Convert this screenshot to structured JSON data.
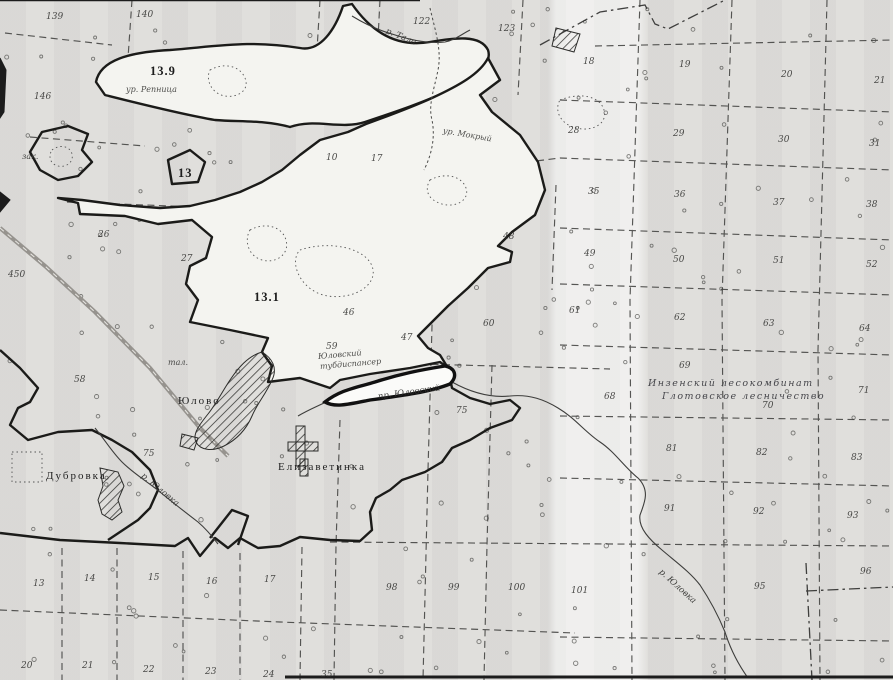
{
  "map": {
    "title": "Лесоустроительный планшет (скан)",
    "district_label": {
      "line1": "Инзенский лесокомбинат",
      "line2": "Глотовское лесничество"
    },
    "settlements": [
      {
        "text": "Юлово",
        "x": 178,
        "y": 395
      },
      {
        "text": "Елизаветинка",
        "x": 278,
        "y": 461
      },
      {
        "text": "Дубровка",
        "x": 46,
        "y": 470
      }
    ],
    "water_labels": [
      {
        "text": "р. Тала",
        "x": 386,
        "y": 26,
        "rotate": 22
      },
      {
        "text": "пр. Юловский",
        "x": 378,
        "y": 392,
        "rotate": -8
      },
      {
        "text": "р. Юловка",
        "x": 142,
        "y": 470,
        "rotate": 40
      },
      {
        "text": "р. Юловка",
        "x": 660,
        "y": 566,
        "rotate": 42
      }
    ],
    "place_labels": [
      {
        "text": "ур. Мокрый",
        "x": 443,
        "y": 126,
        "rotate": 10
      },
      {
        "text": "ур. Репница",
        "x": 126,
        "y": 85,
        "rotate": 0
      },
      {
        "text": "Юловский",
        "x": 318,
        "y": 352,
        "rotate": -5
      },
      {
        "text": "тубдиспансер",
        "x": 320,
        "y": 362,
        "rotate": -5
      },
      {
        "text": "зак.",
        "x": 22,
        "y": 152,
        "rotate": 0
      },
      {
        "text": "тал.",
        "x": 168,
        "y": 358,
        "rotate": 0
      }
    ],
    "compartment_labels": [
      {
        "text": "13.9",
        "x": 150,
        "y": 64
      },
      {
        "text": "13.1",
        "x": 254,
        "y": 290
      },
      {
        "text": "13",
        "x": 178,
        "y": 166
      }
    ],
    "quarter_numbers": [
      {
        "t": "139",
        "x": 46,
        "y": 12
      },
      {
        "t": "140",
        "x": 136,
        "y": 10
      },
      {
        "t": "122",
        "x": 413,
        "y": 17
      },
      {
        "t": "123",
        "x": 498,
        "y": 24
      },
      {
        "t": "146",
        "x": 34,
        "y": 92
      },
      {
        "t": "18",
        "x": 583,
        "y": 57
      },
      {
        "t": "19",
        "x": 679,
        "y": 60
      },
      {
        "t": "20",
        "x": 781,
        "y": 70
      },
      {
        "t": "21",
        "x": 874,
        "y": 76
      },
      {
        "t": "28",
        "x": 568,
        "y": 126
      },
      {
        "t": "29",
        "x": 673,
        "y": 129
      },
      {
        "t": "30",
        "x": 778,
        "y": 135
      },
      {
        "t": "31",
        "x": 869,
        "y": 139
      },
      {
        "t": "35",
        "x": 588,
        "y": 187
      },
      {
        "t": "36",
        "x": 674,
        "y": 190
      },
      {
        "t": "37",
        "x": 773,
        "y": 198
      },
      {
        "t": "38",
        "x": 866,
        "y": 200
      },
      {
        "t": "10",
        "x": 326,
        "y": 153
      },
      {
        "t": "17",
        "x": 371,
        "y": 154
      },
      {
        "t": "26",
        "x": 98,
        "y": 230
      },
      {
        "t": "27",
        "x": 181,
        "y": 254
      },
      {
        "t": "48",
        "x": 503,
        "y": 232
      },
      {
        "t": "49",
        "x": 584,
        "y": 249
      },
      {
        "t": "50",
        "x": 673,
        "y": 255
      },
      {
        "t": "51",
        "x": 773,
        "y": 256
      },
      {
        "t": "52",
        "x": 866,
        "y": 260
      },
      {
        "t": "450",
        "x": 8,
        "y": 270
      },
      {
        "t": "46",
        "x": 343,
        "y": 308
      },
      {
        "t": "47",
        "x": 401,
        "y": 333
      },
      {
        "t": "59",
        "x": 326,
        "y": 342
      },
      {
        "t": "60",
        "x": 483,
        "y": 319
      },
      {
        "t": "61",
        "x": 569,
        "y": 306
      },
      {
        "t": "62",
        "x": 674,
        "y": 313
      },
      {
        "t": "63",
        "x": 763,
        "y": 319
      },
      {
        "t": "64",
        "x": 859,
        "y": 324
      },
      {
        "t": "58",
        "x": 74,
        "y": 375
      },
      {
        "t": "69",
        "x": 679,
        "y": 361
      },
      {
        "t": "68",
        "x": 604,
        "y": 392
      },
      {
        "t": "70",
        "x": 762,
        "y": 401
      },
      {
        "t": "71",
        "x": 858,
        "y": 386
      },
      {
        "t": "75",
        "x": 456,
        "y": 406
      },
      {
        "t": "75",
        "x": 143,
        "y": 449
      },
      {
        "t": "81",
        "x": 666,
        "y": 444
      },
      {
        "t": "82",
        "x": 756,
        "y": 448
      },
      {
        "t": "83",
        "x": 851,
        "y": 453
      },
      {
        "t": "91",
        "x": 664,
        "y": 504
      },
      {
        "t": "92",
        "x": 753,
        "y": 507
      },
      {
        "t": "93",
        "x": 847,
        "y": 511
      },
      {
        "t": "98",
        "x": 386,
        "y": 583
      },
      {
        "t": "99",
        "x": 448,
        "y": 583
      },
      {
        "t": "100",
        "x": 508,
        "y": 583
      },
      {
        "t": "101",
        "x": 571,
        "y": 586
      },
      {
        "t": "95",
        "x": 754,
        "y": 582
      },
      {
        "t": "96",
        "x": 860,
        "y": 567
      },
      {
        "t": "13",
        "x": 33,
        "y": 579
      },
      {
        "t": "14",
        "x": 84,
        "y": 574
      },
      {
        "t": "15",
        "x": 148,
        "y": 573
      },
      {
        "t": "16",
        "x": 206,
        "y": 577
      },
      {
        "t": "17",
        "x": 264,
        "y": 575
      },
      {
        "t": "20",
        "x": 21,
        "y": 661
      },
      {
        "t": "21",
        "x": 82,
        "y": 661
      },
      {
        "t": "22",
        "x": 143,
        "y": 665
      },
      {
        "t": "23",
        "x": 205,
        "y": 667
      },
      {
        "t": "24",
        "x": 263,
        "y": 670
      },
      {
        "t": "35",
        "x": 321,
        "y": 670
      }
    ],
    "colors": {
      "paper": "#e8e7e3",
      "ink": "#2e2e2c",
      "boundary": "#1b1b19",
      "road": "#96938e"
    }
  }
}
